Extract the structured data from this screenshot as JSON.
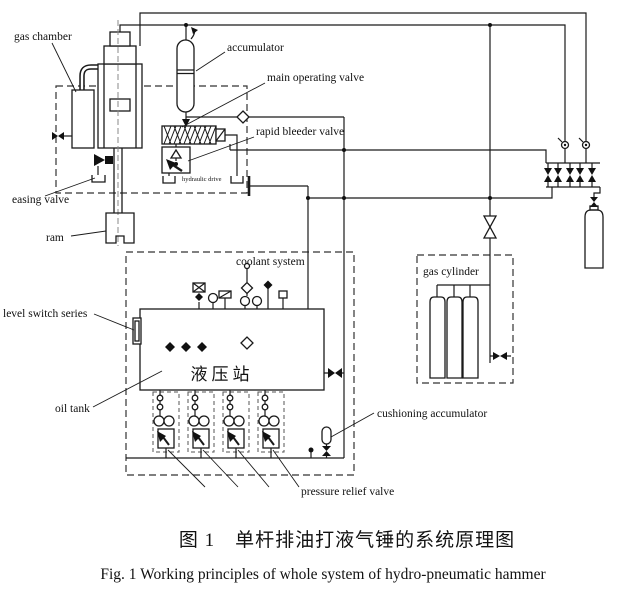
{
  "figure": {
    "caption_zh": "图 1　单杆排油打液气锤的系统原理图",
    "caption_en": "Fig. 1   Working principles of whole system of hydro-pneumatic hammer"
  },
  "labels": {
    "gas_chamber": "gas chamber",
    "accumulator": "accumulator",
    "main_operating_valve": "main operating valve",
    "rapid_bleeder_valve": "rapid bleeder valve",
    "hydraulic_drive": "hydraulic drive",
    "easing_valve": "easing valve",
    "ram": "ram",
    "coolant_system": "coolant system",
    "level_switch_series": "level switch series",
    "oil_tank": "oil tank",
    "hydraulic_station_zh": "液压站",
    "gas_cylinder": "gas cylinder",
    "cushioning_accumulator": "cushioning accumulator",
    "pressure_relief_valve": "pressure relief valve"
  },
  "colors": {
    "line": "#1a1a1a",
    "background": "#ffffff",
    "dashed_box": "#333333"
  }
}
